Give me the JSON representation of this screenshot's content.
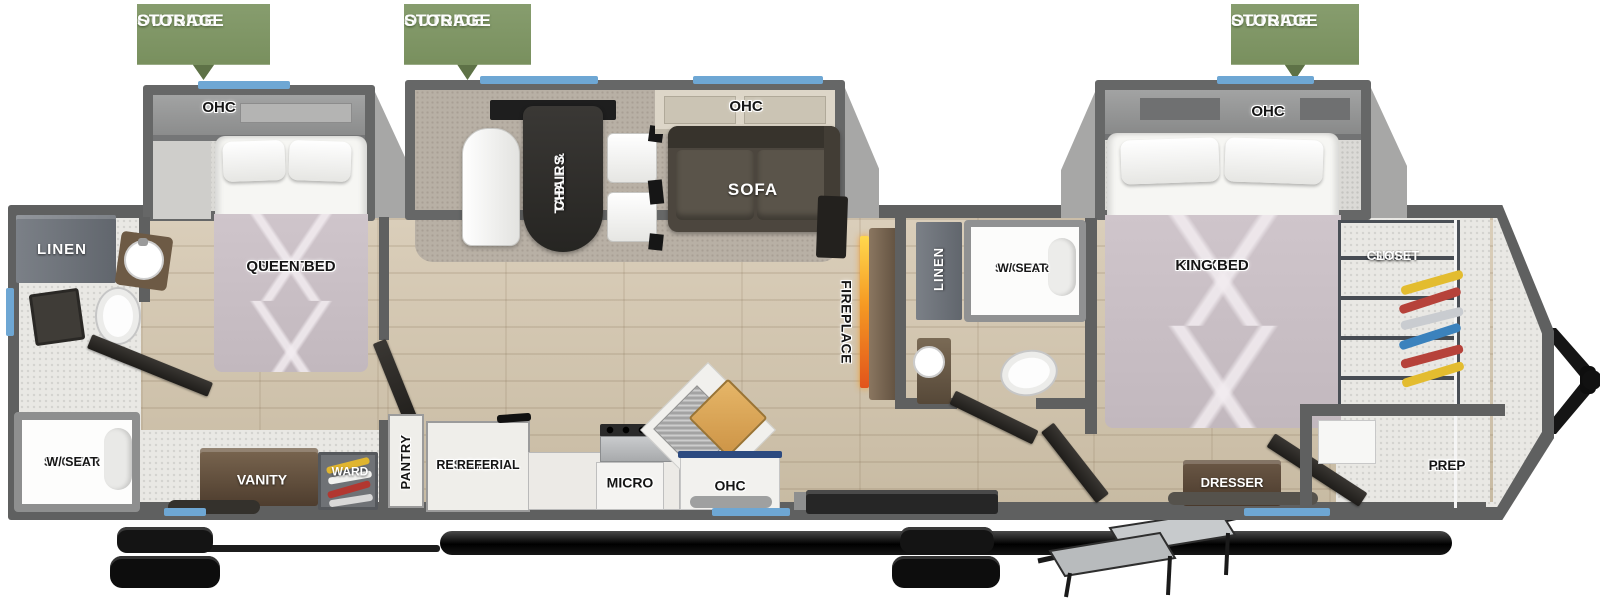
{
  "colors": {
    "banner_green": "#7d9363",
    "wall_gray": "#5f6060",
    "window_blue": "#6ea7d4",
    "flame_orange": "#f08c1f",
    "floor_wood": "#d3c7b2",
    "accent_navy": "#2c4a80"
  },
  "banners": {
    "line1": "OUTSIDE",
    "line2": "STORAGE"
  },
  "rooms": {
    "bedroom_rear": {
      "ohc": "OHC",
      "bed_size": "60\" X 74\"",
      "bed_name": "QUEEN BED"
    },
    "bath_rear": {
      "linen": "LINEN",
      "shower_size": "32\" X 40\"",
      "shower_name": "SHOWER",
      "shower_feature": "W/ SEAT",
      "vanity": "VANITY",
      "wardrobe": "WARD"
    },
    "living": {
      "ohc": "OHC",
      "dinette_line1": "TABLE &",
      "dinette_line2": "CHAIRS",
      "sofa": "SOFA",
      "fireplace": "FIREPLACE"
    },
    "kitchen": {
      "pantry": "PANTRY",
      "refer_line1": "RESIDENTIAL",
      "refer_line2": "STYLE",
      "refer_line3": "REFER",
      "micro": "MICRO",
      "ohc": "OHC"
    },
    "bath_mid": {
      "linen": "LINEN",
      "shower_size": "32\" X 40\"",
      "shower_name": "SHOWER",
      "shower_feature": "W/ SEAT"
    },
    "bedroom_front": {
      "ohc": "OHC",
      "bed_size": "72\" X 80\"",
      "bed_name": "KING BED",
      "dresser": "DRESSER",
      "closet_line1": "SHIRT",
      "closet_line2": "CLOSET",
      "wd_line1": "W/D",
      "wd_line2": "PREP"
    }
  }
}
